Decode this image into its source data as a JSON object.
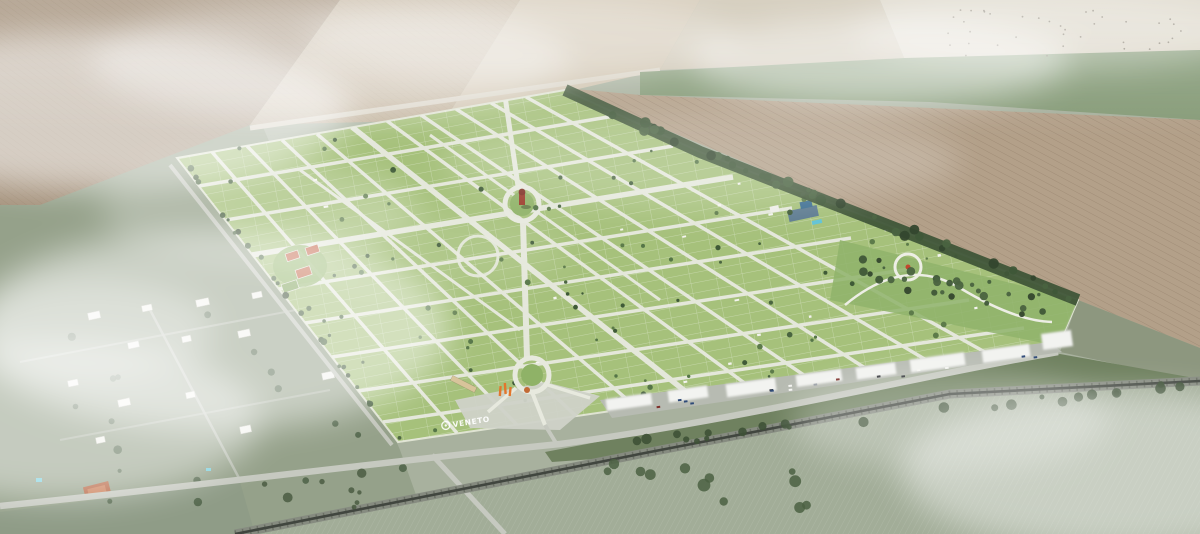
{
  "scene": {
    "description": "Aerial 3D render of a master-planned residential land development surrounded by farmland",
    "logo": {
      "text": "VENETO"
    },
    "palette": {
      "parcel_green": "#a6c17b",
      "street": "#e7e9de",
      "plowed_field": "#b3a089",
      "cream_field": "#d8d2c2",
      "pasture": "#95a18a",
      "woods": "#3f5538",
      "railway": "#41463f",
      "court_red": "#bf5a3c",
      "tower_red": "#9b3b2a",
      "accent_orange": "#e2762c",
      "cloud": "#ffffff"
    }
  }
}
